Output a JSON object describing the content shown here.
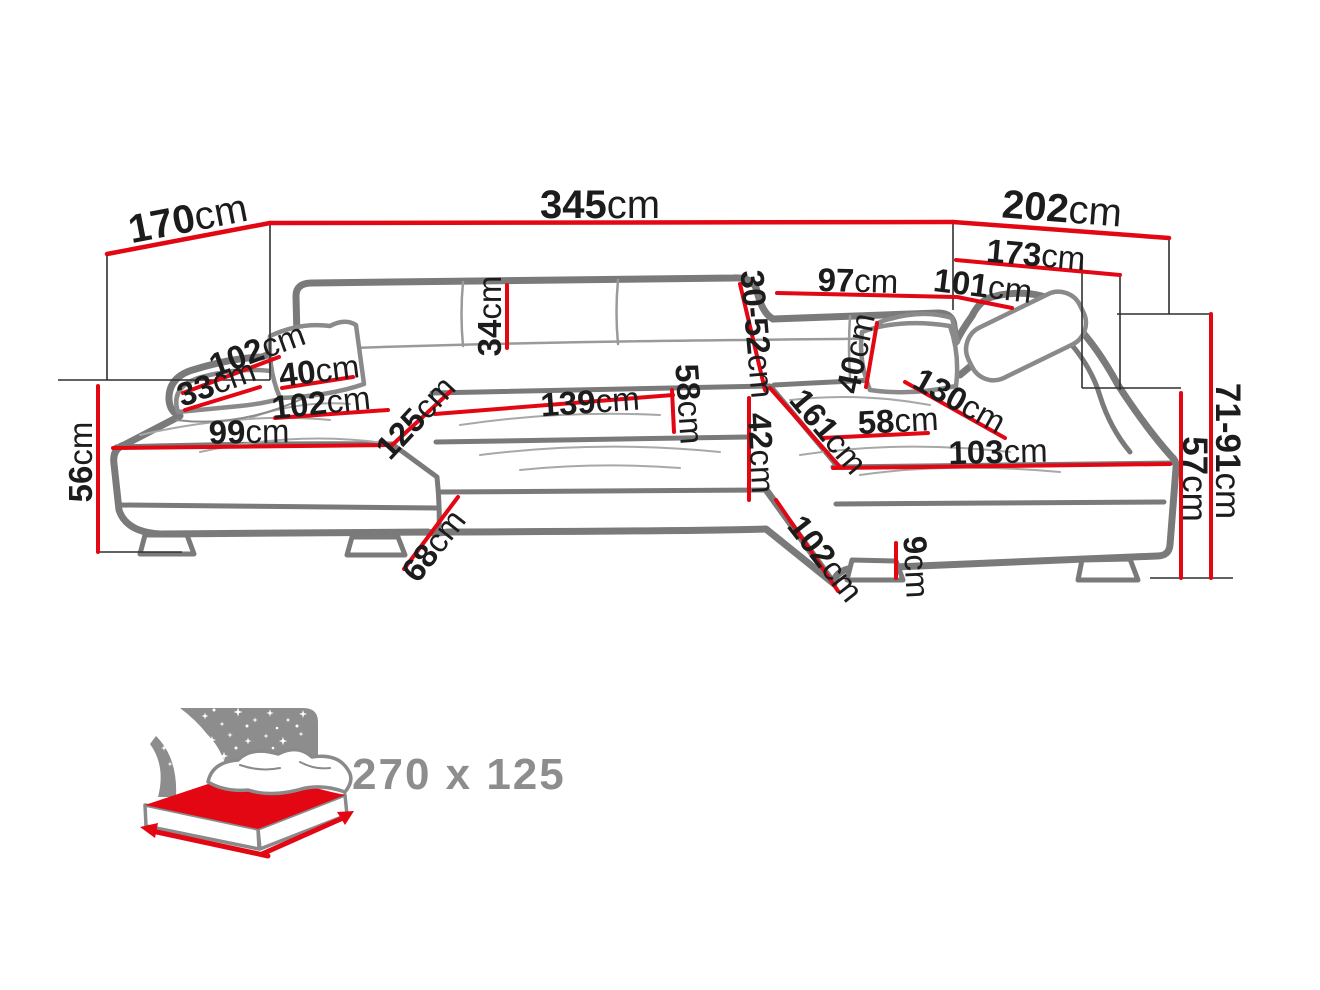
{
  "diagram": {
    "unit": "cm",
    "dims": {
      "d170": "170",
      "d345": "345",
      "d202": "202",
      "d173": "173",
      "d97": "97",
      "d101": "101",
      "d34": "34",
      "d3052": "30-52",
      "d102arm": "102",
      "d33": "33",
      "d40l": "40",
      "d102ls": "102",
      "d99": "99",
      "d125": "125",
      "d139": "139",
      "d58c": "58",
      "d42": "42",
      "d40r": "40",
      "d161": "161",
      "d58r": "58",
      "d130": "130",
      "d103": "103",
      "d56": "56",
      "d68": "68",
      "d102b": "102",
      "d9": "9",
      "d7191": "71-91",
      "d57": "57"
    }
  },
  "sleep_icon": {
    "size": "270 x 125"
  },
  "colors": {
    "dimension_red": "#e30613",
    "sofa_gray": "#7a7a7a",
    "label_black": "#1c1c1c",
    "icon_gray": "#8d8d8d"
  }
}
